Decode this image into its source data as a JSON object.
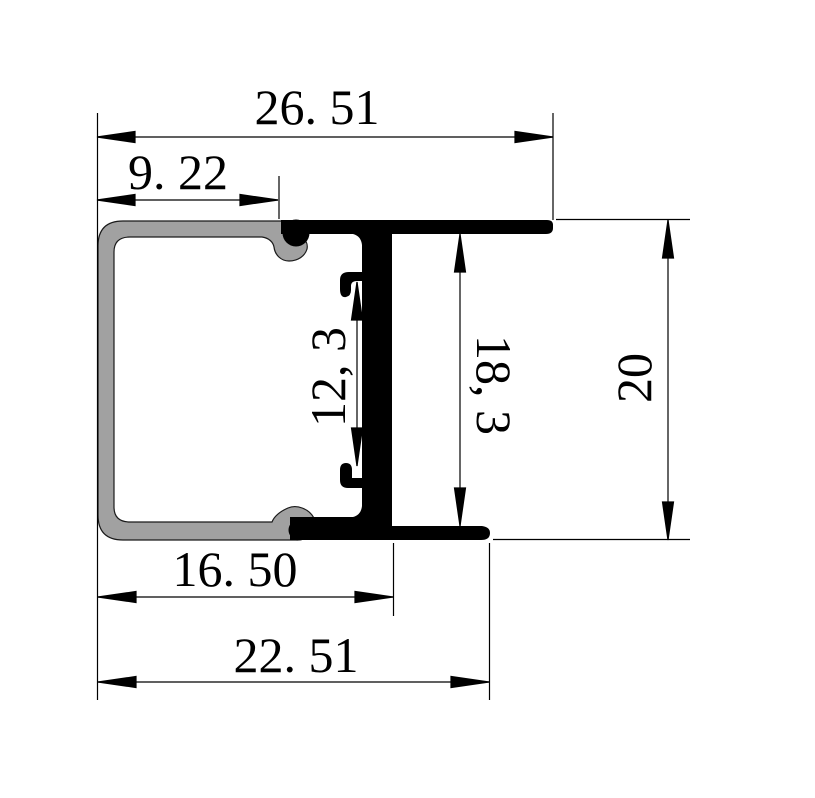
{
  "drawing": {
    "kind": "technical-dimension-drawing",
    "subject": "aluminium-extrusion-profile-cross-section",
    "background": "#ffffff",
    "colors": {
      "channel_fill": "#a1a1a1",
      "channel_outline": "#1a1a1a",
      "insert_fill": "#000000",
      "dimension_line": "#000000",
      "text": "#000000"
    }
  },
  "parts": {
    "channel": "C-shaped grey aluminium channel",
    "insert": "black T-shaped insert profile"
  },
  "dims": {
    "total_width": {
      "label": "26. 51",
      "value": 26.51,
      "orientation": "horizontal"
    },
    "channel_top_width": {
      "label": "9. 22",
      "value": 9.22,
      "orientation": "horizontal"
    },
    "slot_height": {
      "label": "12, 3",
      "value": 12.3,
      "orientation": "vertical"
    },
    "insert_inner_height": {
      "label": "18, 3",
      "value": 18.3,
      "orientation": "vertical"
    },
    "insert_height": {
      "label": "20",
      "value": 20,
      "orientation": "vertical"
    },
    "bottom_inner_width": {
      "label": "16. 50",
      "value": 16.5,
      "orientation": "horizontal"
    },
    "bottom_width": {
      "label": "22. 51",
      "value": 22.51,
      "orientation": "horizontal"
    }
  }
}
